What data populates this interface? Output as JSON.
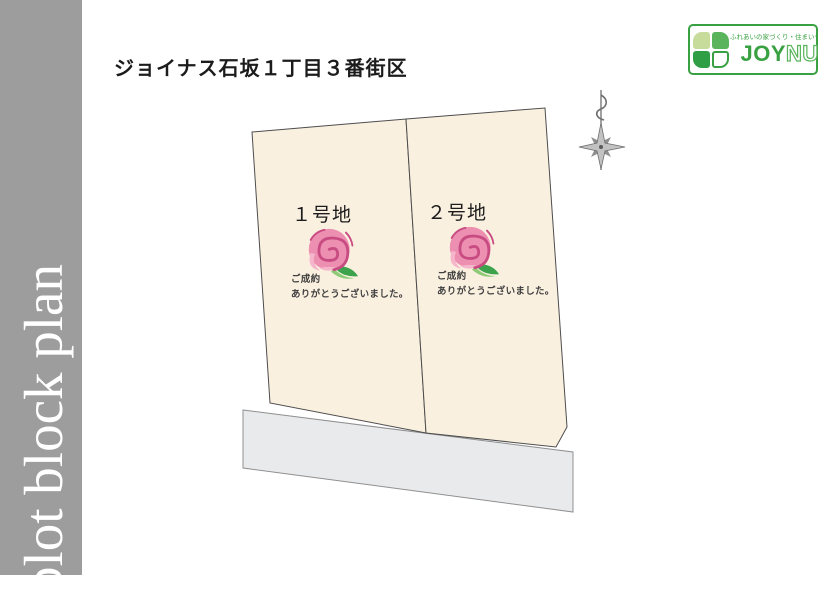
{
  "header": {
    "title": "ジョイナス石坂１丁目３番街区"
  },
  "sidebar": {
    "label": "plot block plan"
  },
  "logo": {
    "slogan": "ふれあいの家づくり・住まいづくり",
    "name_bold": "JOY",
    "name_light": "NUS"
  },
  "plots": [
    {
      "label": "１号地",
      "status_line1": "ご成約",
      "status_line2": "ありがとうございました。"
    },
    {
      "label": "２号地",
      "status_line1": "ご成約",
      "status_line2": "ありがとうございました。"
    }
  ],
  "icons": {
    "compass": "north-compass-star",
    "rose": "sold-rose",
    "clover": "joynus-four-leaf-clover"
  },
  "colors": {
    "sidebar_gray": "#9d9d9d",
    "plot_fill": "#faf0e0",
    "plot_stroke": "#4d4d4d",
    "road_fill": "#e8eaec",
    "road_stroke": "#909090",
    "brand_green": "#3aa143",
    "clover_light": "#c7db9b",
    "clover_mid": "#59b45c",
    "clover_dark": "#2f9e44",
    "rose_pink": "#ec8fb0",
    "rose_pink_light": "#f5b6cb",
    "rose_dark": "#c84c82",
    "leaf_dark": "#3ca24c",
    "leaf_light": "#8ecb77",
    "text_dark": "#1c1c1c",
    "sold_text": "#3f3f3f",
    "compass_fill": "#c2c2c2",
    "compass_dark": "#6e6e6e"
  }
}
